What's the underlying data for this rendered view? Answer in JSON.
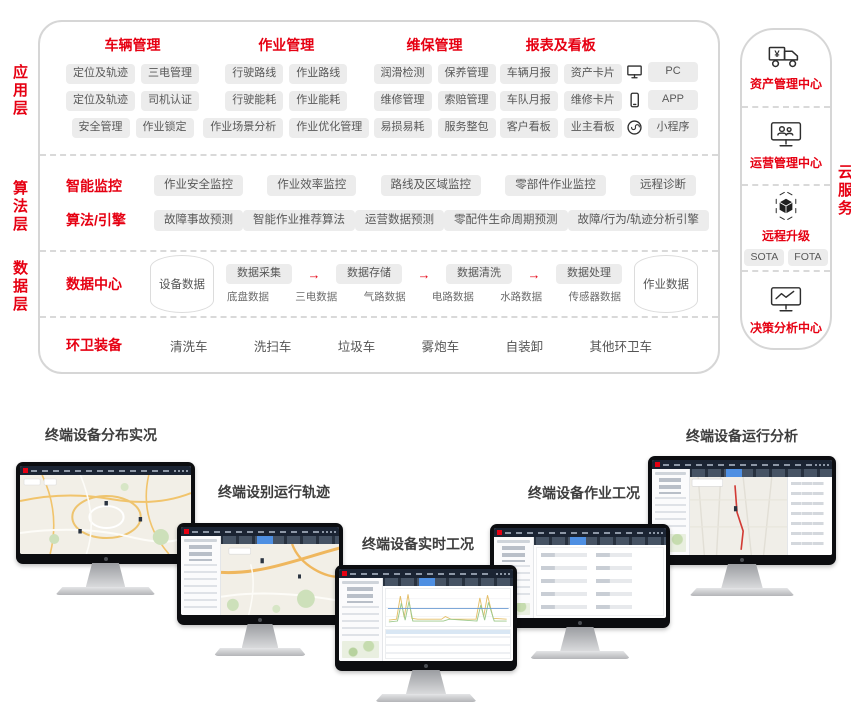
{
  "accent": "#e60012",
  "layers": {
    "app": {
      "label": "应用层",
      "groups": [
        {
          "title": "车辆管理",
          "chips": [
            "定位及轨迹",
            "三电管理",
            "定位及轨迹",
            "司机认证",
            "安全管理",
            "作业锁定"
          ]
        },
        {
          "title": "作业管理",
          "chips": [
            "行驶路线",
            "作业路线",
            "行驶能耗",
            "作业能耗",
            "作业场景分析",
            "作业优化管理"
          ]
        },
        {
          "title": "维保管理",
          "chips": [
            "润滑检测",
            "保养管理",
            "维修管理",
            "索赔管理",
            "易损易耗",
            "服务整包"
          ]
        },
        {
          "title": "报表及看板",
          "chips": [
            "车辆月报",
            "资产卡片",
            "车队月报",
            "维修卡片",
            "客户看板",
            "业主看板"
          ]
        }
      ],
      "devices": [
        {
          "icon": "pc-icon",
          "label": "PC"
        },
        {
          "icon": "phone-icon",
          "label": "APP"
        },
        {
          "icon": "miniapp-icon",
          "label": "小程序"
        }
      ]
    },
    "algo": {
      "label": "算法层",
      "rows": [
        {
          "title": "智能监控",
          "chips": [
            "作业安全监控",
            "作业效率监控",
            "路线及区域监控",
            "零部件作业监控",
            "远程诊断"
          ]
        },
        {
          "title": "算法/引擎",
          "chips": [
            "故障事故预测",
            "智能作业推荐算法",
            "运营数据预测",
            "零配件生命周期预测",
            "故障/行为/轨迹分析引擎"
          ]
        }
      ]
    },
    "data": {
      "label": "数据层",
      "title": "数据中心",
      "left_store": "设备数据",
      "right_store": "作业数据",
      "arrow": "→",
      "flow": [
        "数据采集",
        "数据存储",
        "数据清洗",
        "数据处理"
      ],
      "sources": [
        "底盘数据",
        "三电数据",
        "气路数据",
        "电路数据",
        "水路数据",
        "传感器数据"
      ]
    },
    "equipment": {
      "title": "环卫装备",
      "items": [
        "清洗车",
        "洗扫车",
        "垃圾车",
        "雾炮车",
        "自装卸",
        "其他环卫车"
      ]
    }
  },
  "cloud": {
    "label": "云服务",
    "sections": [
      {
        "icon": "truck-yen-icon",
        "title": "资产管理中心"
      },
      {
        "icon": "monitor-users-icon",
        "title": "运营管理中心"
      },
      {
        "icon": "cube-icon",
        "title": "远程升级",
        "chips": [
          "SOTA",
          "FOTA"
        ]
      },
      {
        "icon": "monitor-chart-icon",
        "title": "决策分析中心"
      }
    ]
  },
  "monitors": [
    {
      "label": "终端设备分布实况",
      "view": "map-overview"
    },
    {
      "label": "终端设别运行轨迹",
      "view": "map-with-sidebar"
    },
    {
      "label": "终端设备实时工况",
      "view": "realtime-charts"
    },
    {
      "label": "终端设备作业工况",
      "view": "detail-form"
    },
    {
      "label": "终端设备运行分析",
      "view": "track-analysis"
    }
  ]
}
